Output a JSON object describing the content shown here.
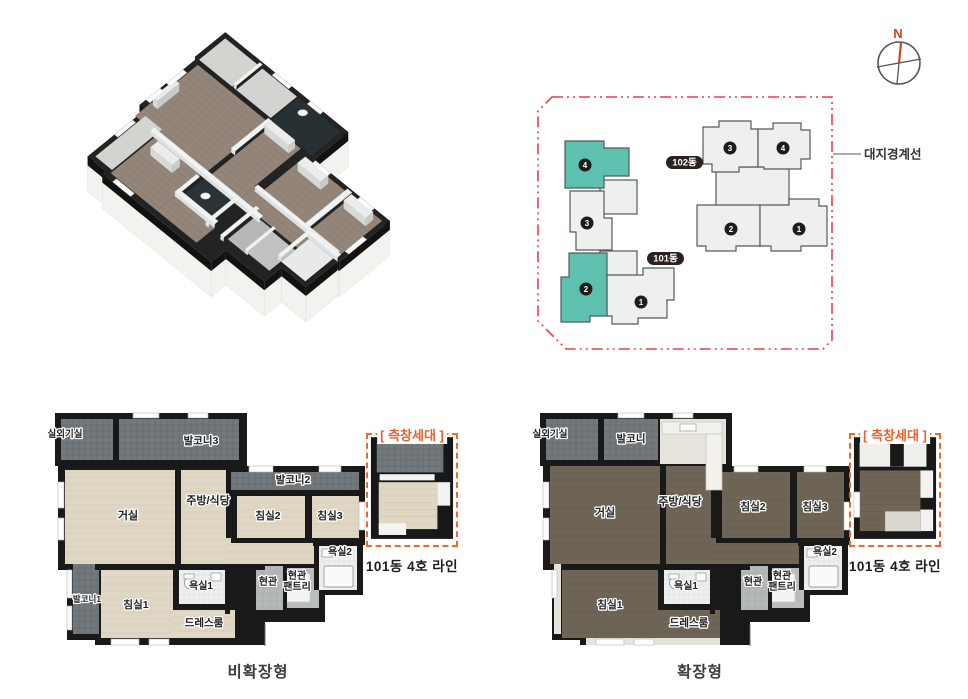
{
  "site_plan": {
    "compass_label": "N",
    "boundary_label": "대지경계선",
    "buildings": [
      {
        "name": "101동",
        "units": [
          {
            "no": "4",
            "highlight": true
          },
          {
            "no": "3",
            "highlight": false
          },
          {
            "no": "2",
            "highlight": true
          },
          {
            "no": "1",
            "highlight": false
          }
        ]
      },
      {
        "name": "102동",
        "units": [
          {
            "no": "3",
            "highlight": false
          },
          {
            "no": "4",
            "highlight": false
          },
          {
            "no": "2",
            "highlight": false
          },
          {
            "no": "1",
            "highlight": false
          }
        ]
      }
    ],
    "colors": {
      "highlight_teal": "#5ec0ae",
      "unit_gray": "#eef0ee",
      "boundary_red": "#e8404a",
      "pill_dark": "#2b2220",
      "compass_orange": "#cc4426"
    }
  },
  "plan_basic": {
    "caption": "비확장형",
    "side_box": {
      "title": "[ 측창세대 ]",
      "caption": "101동 4호 라인"
    },
    "rooms": {
      "outdoor_unit": "실외기실",
      "balcony3": "발코니3",
      "balcony2": "발코니2",
      "balcony1": "발코니1",
      "living": "거실",
      "kitchen": "주방/식당",
      "bed2": "침실2",
      "bed3": "침실3",
      "bed1": "침실1",
      "bath1": "욕실1",
      "bath2": "욕실2",
      "dress": "드레스룸",
      "entry": "현관",
      "pantry_line1": "현관",
      "pantry_line2": "팬트리"
    }
  },
  "plan_extended": {
    "caption": "확장형",
    "side_box": {
      "title": "[ 측창세대 ]",
      "caption": "101동 4호 라인"
    },
    "rooms": {
      "outdoor_unit": "실외기실",
      "balcony": "발코니",
      "living": "거실",
      "kitchen": "주방/식당",
      "bed2": "침실2",
      "bed3": "침실3",
      "bed1": "침실1",
      "bath1": "욕실1",
      "bath2": "욕실2",
      "dress": "드레스룸",
      "entry": "현관",
      "pantry_line1": "현관",
      "pantry_line2": "팬트리"
    }
  }
}
